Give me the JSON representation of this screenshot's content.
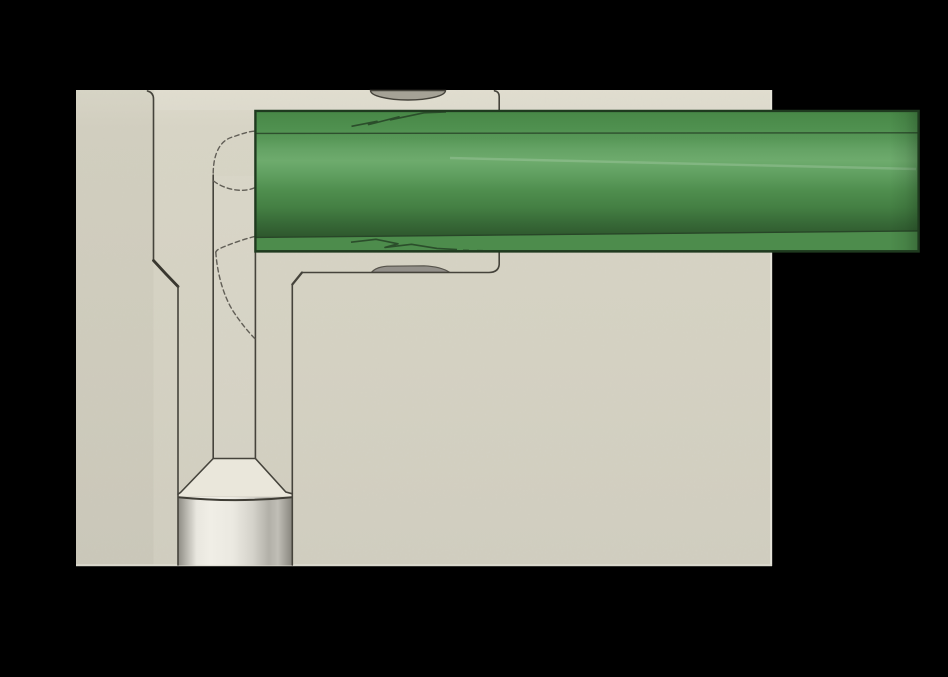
{
  "colors": {
    "background": "#000000",
    "block": "#d5d2c3",
    "block_top": "#dedbcc",
    "block_bottom": "#d1cec0",
    "edge_line": "#45433b",
    "chamfer_line": "#39372f",
    "hidden_line": "#615e56",
    "edge_highlight": "#e6e4da",
    "bottom_highlight": "#dcdacf",
    "rod_top": "#478746",
    "rod_mid": "#4f904f",
    "rod_highlight": "#6eab6d",
    "rod_dark": "#2d552c",
    "rod_band": "#4d8c4c",
    "rod_outline": "#1f3a1f",
    "rod_seam": "#2e4f2e",
    "pin_light": "#f0eee6",
    "pin_dark": "#908e86",
    "pin_top_line": "#3f3d35",
    "taper": "#eae7db",
    "hole": "#a5a296",
    "bump": "#93908a",
    "scratch": "#2b4e2b"
  }
}
